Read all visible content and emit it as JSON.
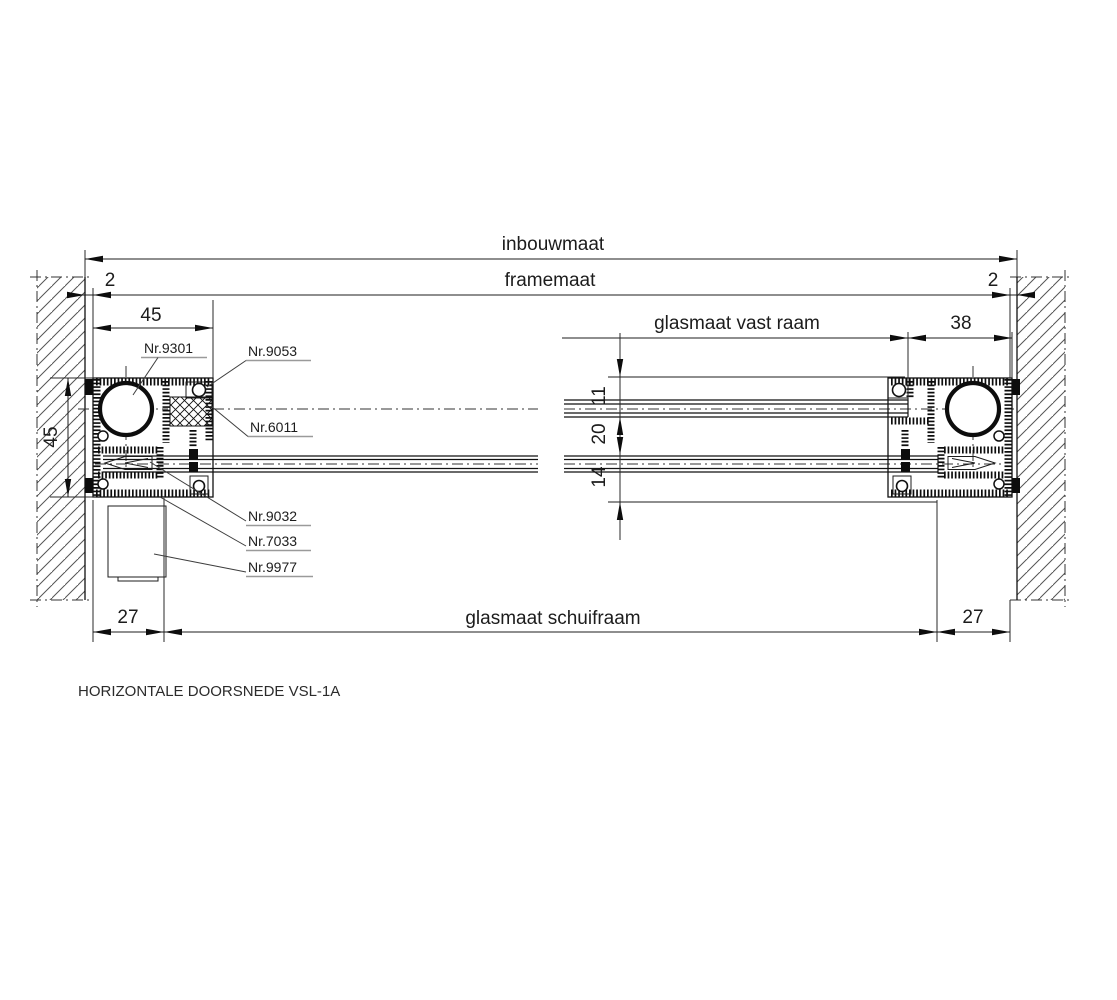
{
  "drawing": {
    "title": "HORIZONTALE DOORSNEDE VSL-1A",
    "dimensions": {
      "inbouwmaat": "inbouwmaat",
      "framemaat": "framemaat",
      "gap_left": "2",
      "gap_right": "2",
      "frame_width_left": "45",
      "frame_width_right": "38",
      "glasmaat_vast_raam": "glasmaat vast raam",
      "frame_depth": "45",
      "glass_front": "11",
      "glass_between": "20",
      "glass_back": "14",
      "overlap_left": "27",
      "glasmaat_schuifraam": "glasmaat schuifraam",
      "overlap_right": "27"
    },
    "part_labels": {
      "p9301": "Nr.9301",
      "p9053": "Nr.9053",
      "p6011": "Nr.6011",
      "p9032": "Nr.9032",
      "p7033": "Nr.7033",
      "p9977": "Nr.9977"
    },
    "colors": {
      "line": "#1c1c1c",
      "leader": "#3d3d3d",
      "underline": "#9a9a9a",
      "hatch": "#555555"
    }
  }
}
